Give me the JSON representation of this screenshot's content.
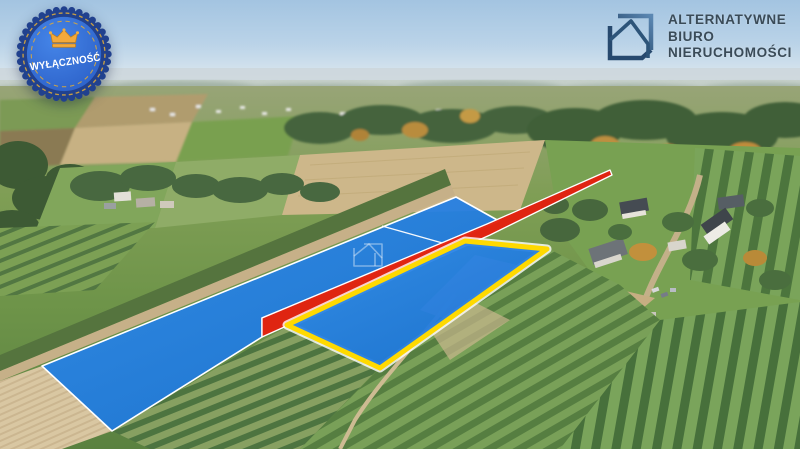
{
  "badge": {
    "label": "WYŁĄCZNOŚĆ",
    "icon": "crown-icon",
    "outer_ring_color": "#21418e",
    "disc_color": "#2d68cf",
    "gold_trim_color": "#d9a83c",
    "label_color": "#ffffff"
  },
  "logo": {
    "lines": [
      "ALTERNATYWNE",
      "BIURO",
      "NIERUCHOMOŚCI"
    ],
    "icon": "house-logo-icon",
    "text_color": "#3a4b58"
  },
  "overlays": {
    "parcel_fill_color": "#1b7ce6",
    "access_road_color": "#e3210f",
    "highlight_border_color": "#ffd900",
    "outline_color": "#ffffff",
    "watermark": "house-outline-watermark"
  },
  "scene": {
    "type": "aerial-drone-photo",
    "subject": "rural fields and orchards with two blue highlighted parcels, a red access road overlay and a yellow-outlined plot"
  }
}
